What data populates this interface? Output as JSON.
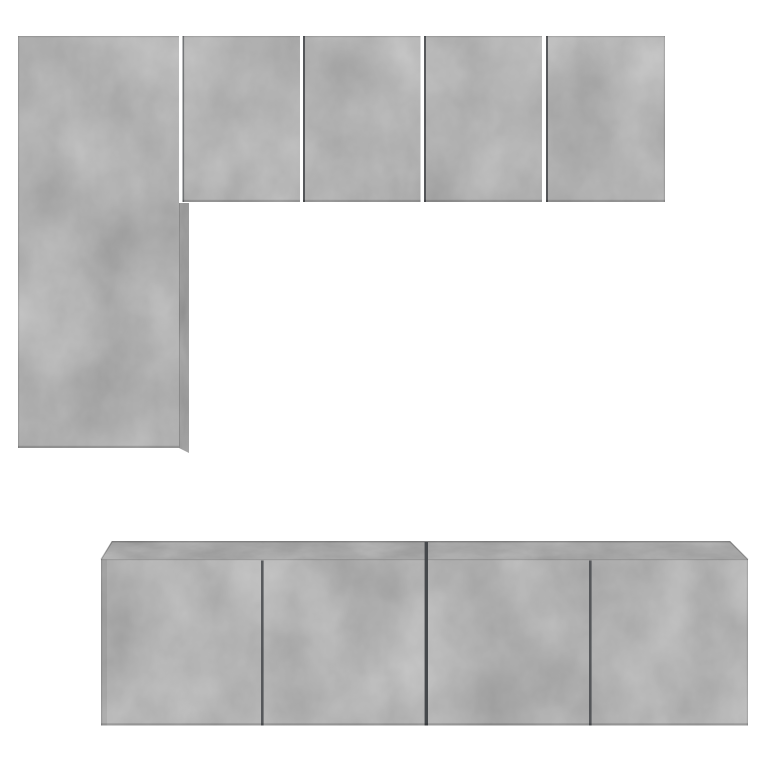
{
  "scene": {
    "type": "product-photo",
    "subject": "Modular wall-mounted cabinet set in concrete grey arranged in two groups on a plain white studio background",
    "finish": "concrete grey",
    "background_description": "plain white, no text or watermark",
    "top_group": {
      "label": "upper wall arrangement (L-shape)",
      "pieces": [
        {
          "label": "tall vertical wall cabinet"
        },
        {
          "label": "square wall cabinet"
        },
        {
          "label": "square wall cabinet"
        },
        {
          "label": "square wall cabinet"
        },
        {
          "label": "square wall cabinet"
        }
      ]
    },
    "bottom_group": {
      "label": "lower wall-mounted TV bench row",
      "pieces": [
        {
          "label": "two-door wall-mounted TV cabinet"
        },
        {
          "label": "two-door wall-mounted TV cabinet"
        }
      ]
    }
  },
  "colors": {
    "background": "#ffffff",
    "concrete": "#b1b3b4",
    "concrete_top": "#a7a9aa",
    "concrete_side": "#9da0a1",
    "seam": "#45484b",
    "seam_soft": "#54575a",
    "edge_line": "rgba(0,0,0,0.12)",
    "edge_shadow": "rgba(0,0,0,0.17)",
    "left_shade": "rgba(0,0,0,0.06)",
    "outline": "rgba(0,0,0,0.22)"
  }
}
